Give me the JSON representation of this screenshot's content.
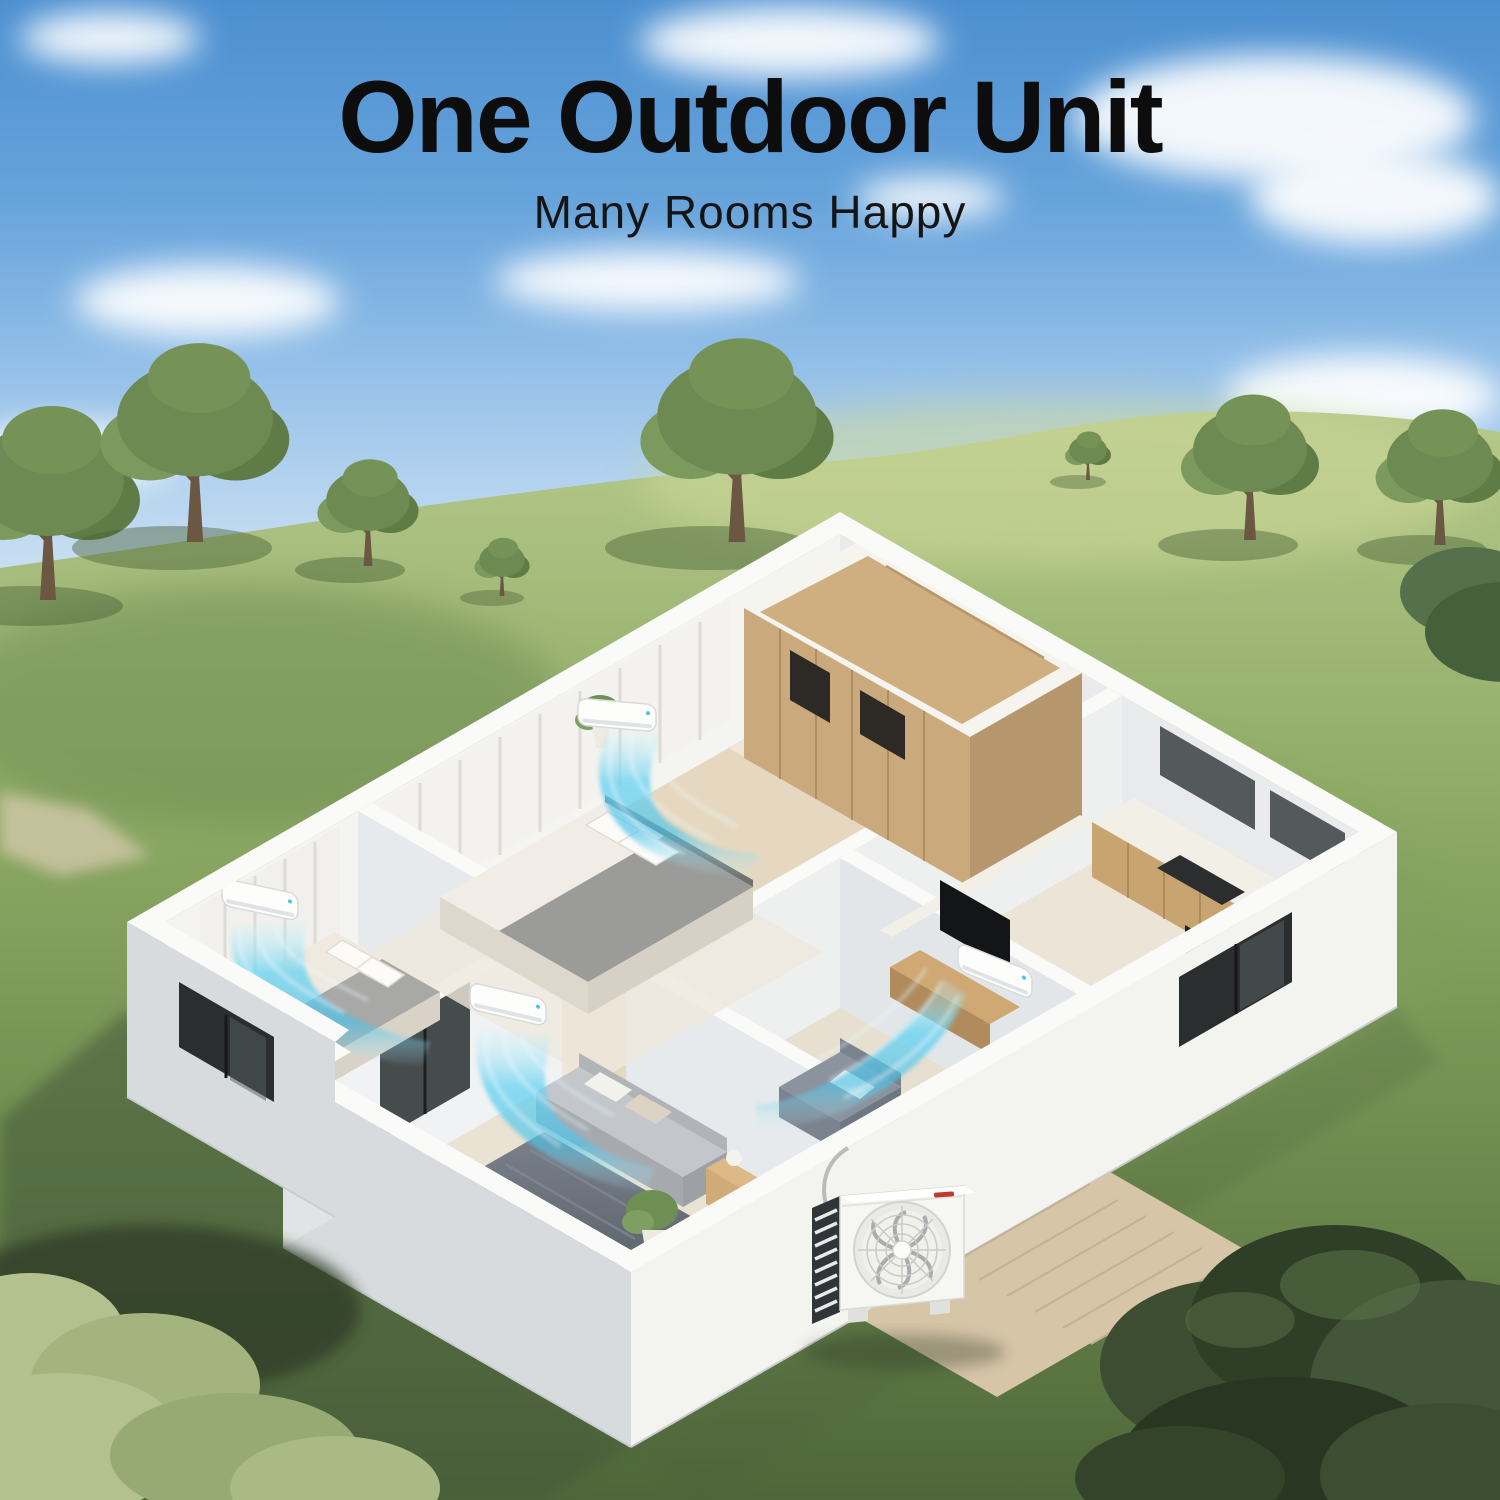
{
  "header": {
    "title": "One Outdoor Unit",
    "subtitle": "Many Rooms Happy"
  },
  "scene": {
    "indoor_ac_unit_count": 4,
    "outdoor_unit_count": 1,
    "colors": {
      "sky_top": "#4c8fd0",
      "sky_horizon": "#dcebf7",
      "cloud": "#ffffff",
      "grass_light": "#b6c98c",
      "grass_dark": "#4e6639",
      "wall_lit": "#f3f3f0",
      "wall_shade": "#d7dbde",
      "floor_wood": "#e6d8c0",
      "closet_wood": "#cfae7f",
      "airflow_cyan": "#5ecdee",
      "window_glass": "#2b2e2f",
      "title_text": "#0d0d0d",
      "brand_mark_red": "#c0392b"
    }
  }
}
